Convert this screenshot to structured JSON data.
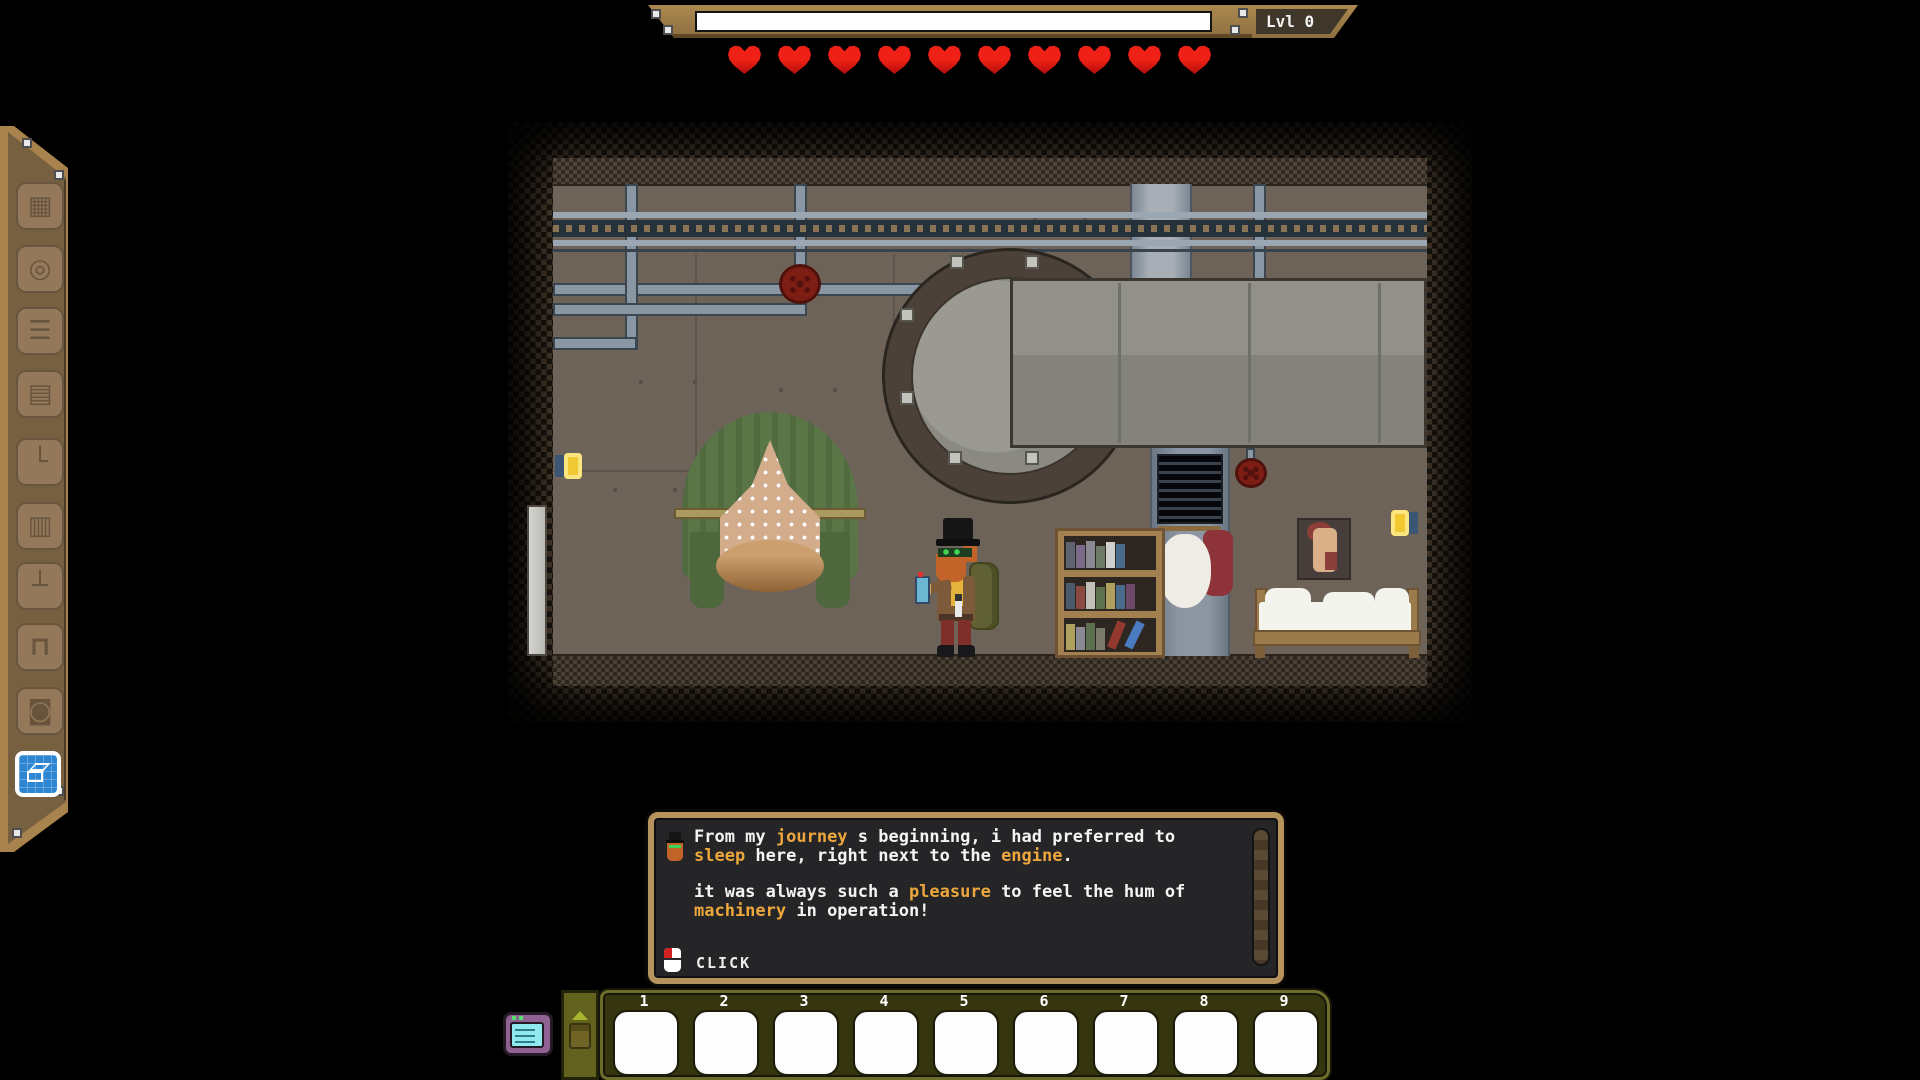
{
  "hud": {
    "level_label": "Lvl 0",
    "xp_fill": 1,
    "hearts_count": 10
  },
  "sidebar": {
    "items": [
      {
        "id": "map",
        "icon": "map-icon",
        "glyph": "▦"
      },
      {
        "id": "disc",
        "icon": "record-disc-icon",
        "glyph": "◎"
      },
      {
        "id": "press",
        "icon": "press-machine-icon",
        "glyph": "☰"
      },
      {
        "id": "radio",
        "icon": "radio-icon",
        "glyph": "▤"
      },
      {
        "id": "pipe",
        "icon": "pipe-elbow-icon",
        "glyph": "└"
      },
      {
        "id": "grate",
        "icon": "furnace-grate-icon",
        "glyph": "▥"
      },
      {
        "id": "lever",
        "icon": "lever-icon",
        "glyph": "┴"
      },
      {
        "id": "workbench",
        "icon": "workbench-icon",
        "glyph": "⊓"
      },
      {
        "id": "mirror",
        "icon": "mirror-icon",
        "glyph": "◙"
      }
    ],
    "active": {
      "id": "blueprint",
      "icon": "blueprint-icon"
    }
  },
  "scene": {
    "objects": [
      "ceiling-rail",
      "pipes",
      "red-valve",
      "steam-engine",
      "duct",
      "vent",
      "coat-rack",
      "canopy-hammock",
      "wall-lamp-left",
      "wall-lamp-right",
      "door-pole",
      "player-character",
      "bookshelf",
      "wall-poster",
      "bed"
    ],
    "bookshelf": {
      "rows": [
        [
          "#5d6470",
          "#7b6b8a",
          "#8a8a95",
          "#6e7a68",
          "#cfcfcf",
          "#4a6b8a"
        ],
        [
          "#4a5a6a",
          "#8a4a42",
          "#c0c0b8",
          "#5d7050",
          "#b0a060",
          "#4a6b8a",
          "#6e4a6a"
        ],
        [
          "#b0a060",
          "#8a8a95",
          "#5d7050",
          "#7a7a6a"
        ]
      ],
      "diagonal": [
        "#93392f",
        "#4a7bc0"
      ]
    }
  },
  "dialog": {
    "speaker_icon": "top-hat-character-portrait",
    "para1": [
      {
        "t": "From my "
      },
      {
        "t": "journey",
        "hl": true
      },
      {
        "t": " s beginning, i had preferred to "
      },
      {
        "t": "sleep",
        "hl": true
      },
      {
        "t": " here, right next to the "
      },
      {
        "t": "engine",
        "hl": true
      },
      {
        "t": "."
      }
    ],
    "para2": [
      {
        "t": "it was always such a "
      },
      {
        "t": "pleasure",
        "hl": true
      },
      {
        "t": " to feel the hum of "
      },
      {
        "t": "machinery",
        "hl": true
      },
      {
        "t": " in operation!"
      }
    ],
    "prompt": "CLICK"
  },
  "hotbar": {
    "slot_labels": [
      "1",
      "2",
      "3",
      "4",
      "5",
      "6",
      "7",
      "8",
      "9"
    ]
  },
  "colors": {
    "gold": "#eda73d",
    "heart-red": "#e3190f",
    "tan": "#a9834d",
    "panel-brown": "#77603f",
    "wall": "#6d6359",
    "rail-dark": "#26323a",
    "pipe": "#8997a4",
    "engine-gray": "#8b8b84",
    "ring-brown": "#4c4138",
    "duct": "#9fa8b2",
    "valve-red": "#7e1d14",
    "canopy-green": "#5a7647",
    "lace": "#d3ac8c",
    "lamp-yellow": "#f0c832",
    "dialog-bg": "#252528",
    "dialog-frame": "#b6935c",
    "hotbar-olive": "#35350f",
    "hotbar-border": "#6d6d2a",
    "active-blue": "#2e86d3",
    "slot-white": "#fdfdfd"
  }
}
